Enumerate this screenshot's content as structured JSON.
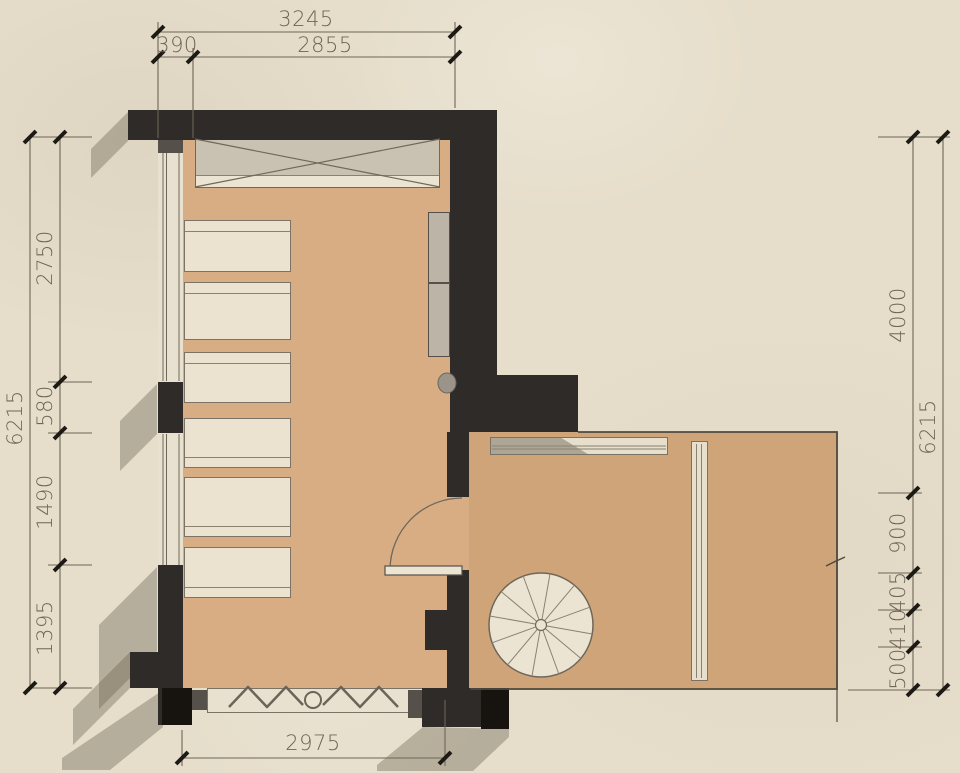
{
  "dimensions": {
    "top": {
      "overall": "3245",
      "segment_left": "390",
      "segment_right": "2855"
    },
    "left": {
      "overall": "6215",
      "segments": [
        "2750",
        "580",
        "1490",
        "1395"
      ]
    },
    "right": {
      "overall": "6215",
      "segments": [
        "4000",
        "900",
        "405",
        "410",
        "500"
      ]
    },
    "bottom": {
      "overall": "2975"
    }
  },
  "colors": {
    "wall_dark": "#2e2b28",
    "wall_black": "#17140f",
    "floor_left_room": "#d8ad83",
    "floor_right_room": "#cfa478",
    "paper_background": "#e6decb",
    "furniture_cream": "#ebe2d0",
    "cabinet_gray": "#bcb4a6",
    "dimension_ink": "#6e6557"
  }
}
